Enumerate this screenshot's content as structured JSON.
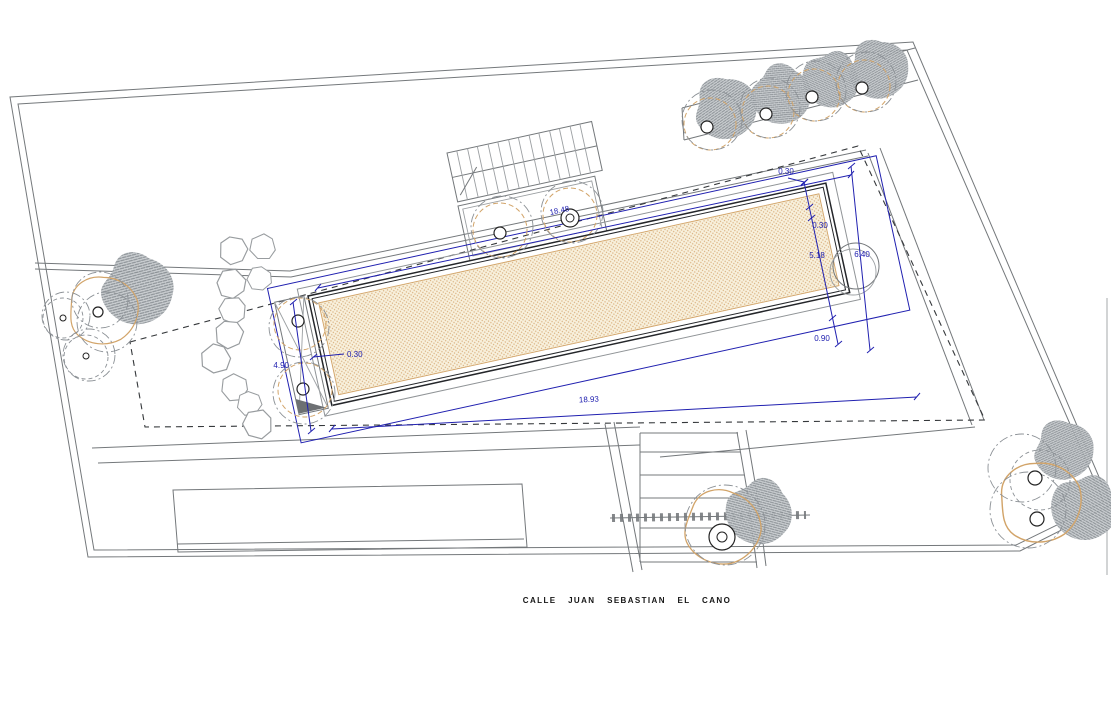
{
  "drawing": {
    "street_label": "CALLE JUAN SEBASTIAN EL CANO",
    "dimensions": {
      "coping_top": "0.30",
      "edge_gap_right": "0.30",
      "pool_width": "5.18",
      "spa_gap": "6.40",
      "bottom_gap": "0.90",
      "length_top": "18.48",
      "length_bottom": "18.93",
      "left_end_width": "4.90",
      "edge_gap_left": "0.30"
    },
    "colors": {
      "dimension": "#2020b0",
      "pool_fill": "#f8f1dd",
      "pool_dot": "#d9af7e",
      "tree_outline": "#d2a469",
      "canopy_base": "#c6cacd",
      "canopy_line": "#878d92"
    }
  }
}
